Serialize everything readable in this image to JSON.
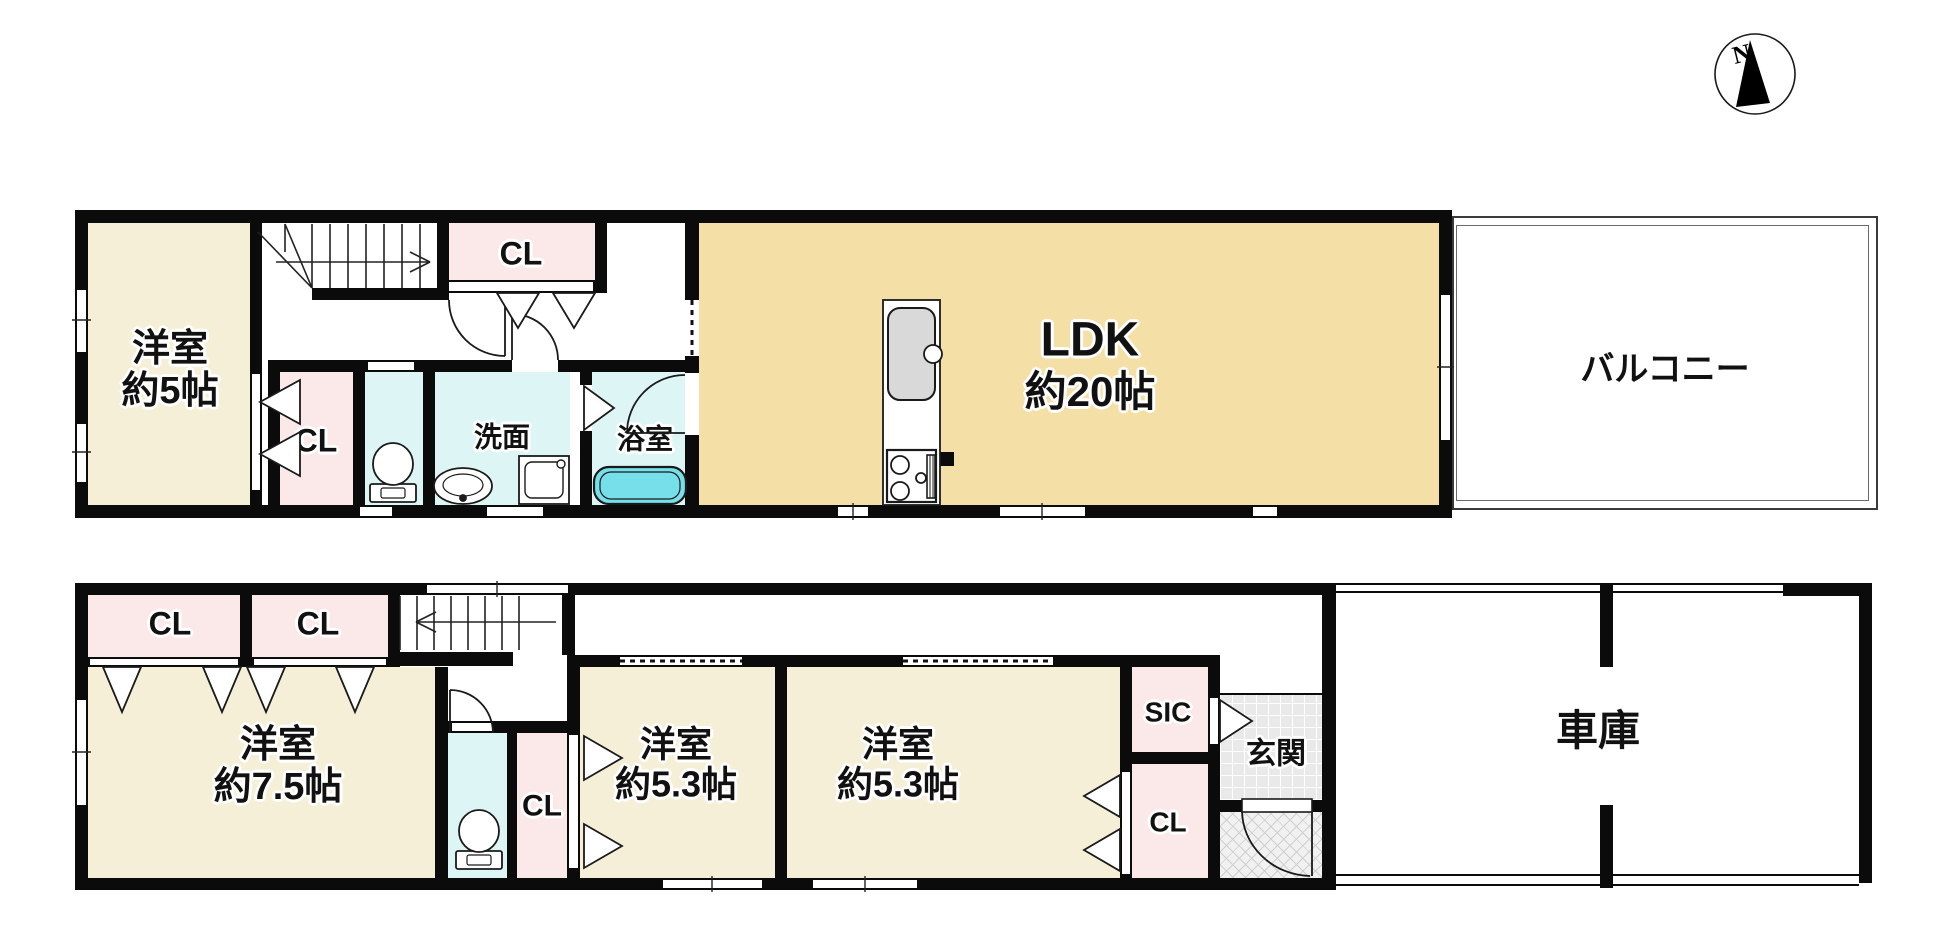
{
  "compass": {
    "north_label": "N"
  },
  "floor2": {
    "bedroom": {
      "name": "洋室",
      "size": "約5帖"
    },
    "closet_top": {
      "label": "CL"
    },
    "closet_side": {
      "label": "CL"
    },
    "washroom": {
      "label": "洗面"
    },
    "bathroom": {
      "label": "浴室"
    },
    "ldk": {
      "name": "LDK",
      "size": "約20帖"
    },
    "balcony": {
      "label": "バルコニー"
    }
  },
  "floor1": {
    "closet_a": {
      "label": "CL"
    },
    "closet_b": {
      "label": "CL"
    },
    "bedroom_main": {
      "name": "洋室",
      "size": "約7.5帖"
    },
    "closet_c": {
      "label": "CL"
    },
    "bedroom_b": {
      "name": "洋室",
      "size": "約5.3帖"
    },
    "bedroom_c": {
      "name": "洋室",
      "size": "約5.3帖"
    },
    "shoe_closet": {
      "label": "SIC"
    },
    "closet_d": {
      "label": "CL"
    },
    "entrance": {
      "label": "玄関"
    },
    "garage": {
      "label": "車庫"
    }
  },
  "colors": {
    "wall": "#0b0b0b",
    "room_cream": "#f6efd8",
    "ldk_tan": "#f4dfa6",
    "closet_pink": "#fbe9e9",
    "wet_cyan": "#def5f6",
    "tub_cyan": "#76dfe9",
    "tile_gray": "#e9e9e9",
    "porch_gray": "#f1f1f1"
  }
}
